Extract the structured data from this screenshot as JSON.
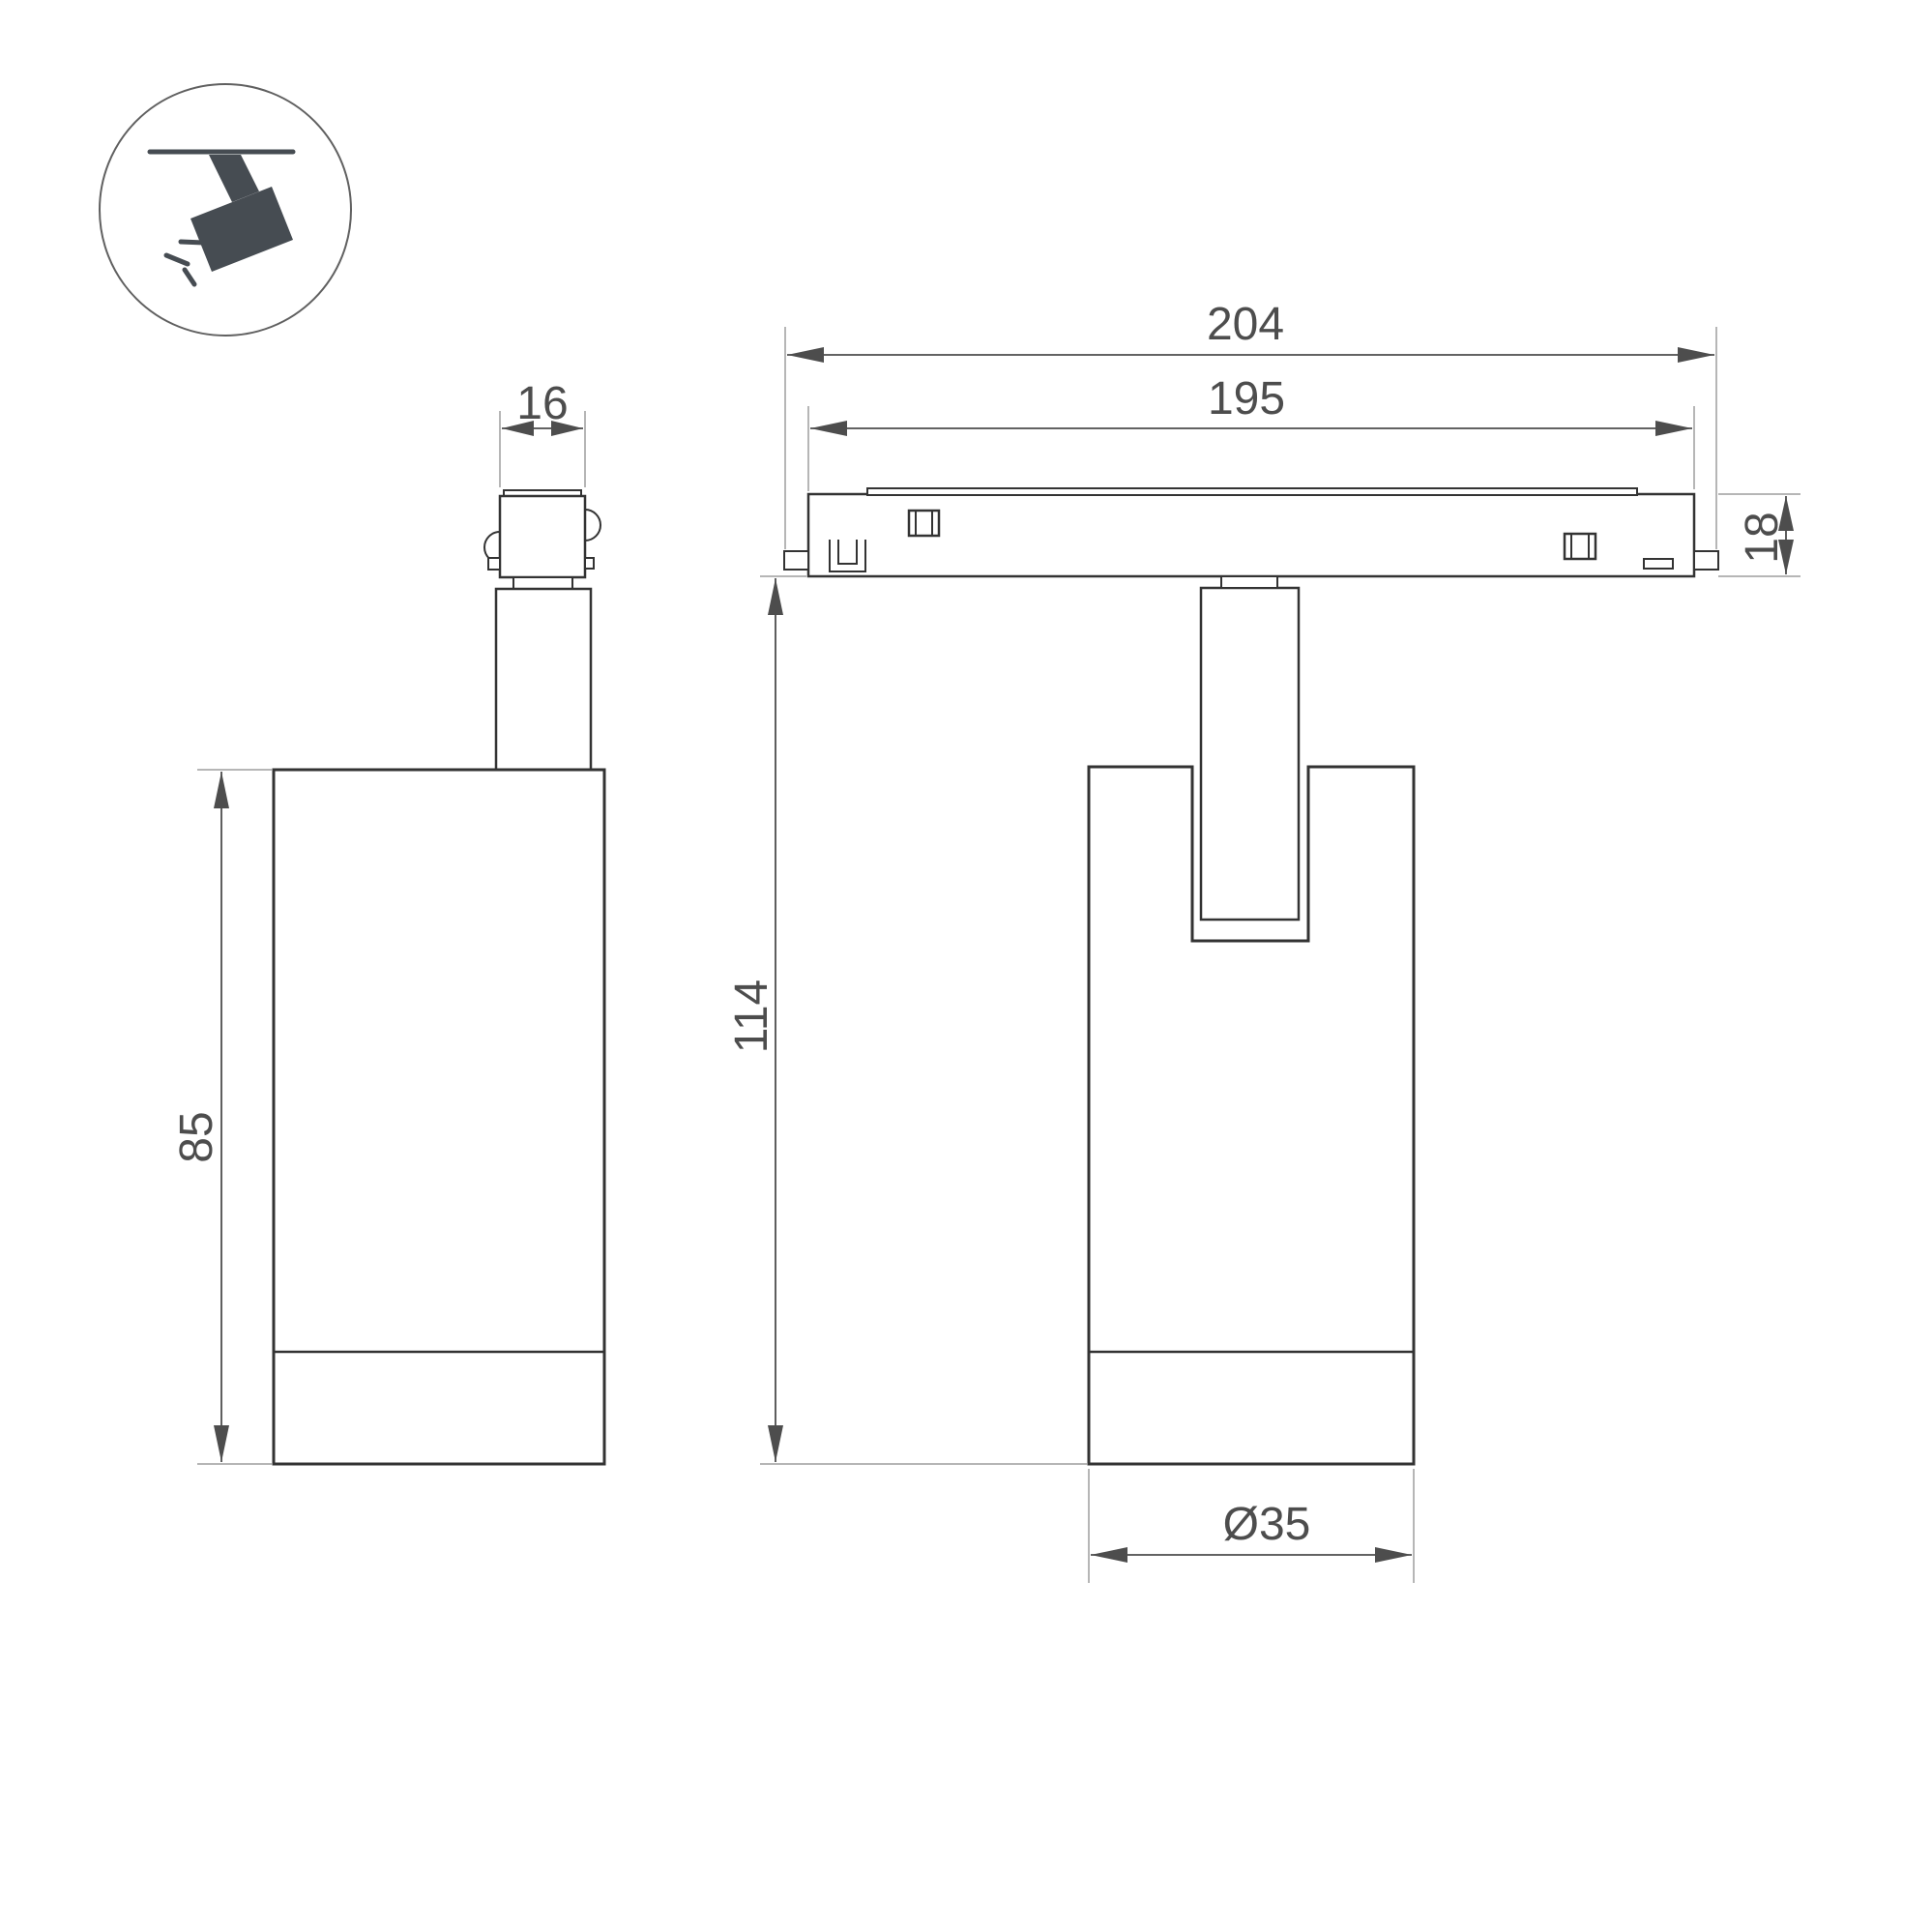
{
  "page": {
    "background": "#ffffff",
    "type": "technical dimension drawing"
  },
  "icon": {
    "label": "ceiling track spotlight pictogram"
  },
  "dimensions": {
    "adapter_width": "16",
    "overall_length": "204",
    "track_length": "195",
    "track_height": "18",
    "housing_height": "85",
    "overall_height": "114",
    "housing_diameter": "Ø35"
  },
  "colors": {
    "outline": "#333333",
    "dim": "#4d4d4d",
    "ext": "#9e9e9e",
    "icon": "#464c52",
    "circle": "#606060",
    "text": "#4d4d4d",
    "background": "#ffffff"
  }
}
